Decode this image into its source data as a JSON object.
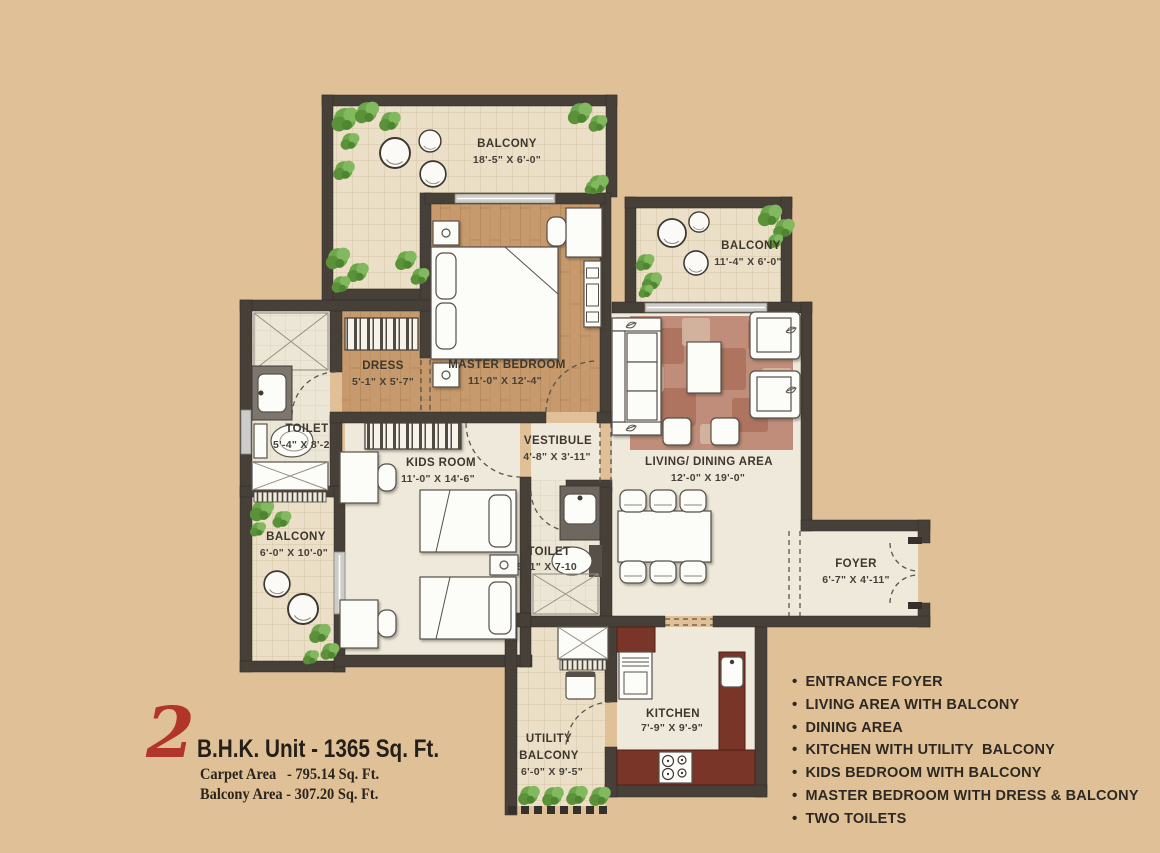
{
  "meta": {
    "description": "2 BHK apartment floor plan"
  },
  "colors": {
    "background": "#e0c197",
    "wall": "#474039",
    "accent_red": "#b23529",
    "wood_floor": "#c79a6d",
    "balcony_tile": "#ebdfc7",
    "kitchen_counter": "#7a3529",
    "rug": "#c08d7b"
  },
  "title": {
    "big_number": "2",
    "heading": "B.H.K. Unit - 1365 Sq. Ft.",
    "carpet_line": "Carpet Area   - 795.14 Sq. Ft.",
    "balcony_line": "Balcony Area - 307.20 Sq. Ft."
  },
  "bullets": {
    "marker": "•"
  },
  "features": [
    "ENTRANCE FOYER",
    "LIVING AREA WITH BALCONY",
    "DINING AREA",
    "KITCHEN WITH UTILITY  BALCONY",
    "KIDS BEDROOM WITH BALCONY",
    "MASTER BEDROOM WITH DRESS & BALCONY",
    "TWO TOILETS"
  ],
  "rooms": {
    "balcony_top": {
      "name": "BALCONY",
      "dims": "18'-5\" X 6'-0\""
    },
    "balcony_right": {
      "name": "BALCONY",
      "dims": "11'-4\" X 6'-0\""
    },
    "balcony_left": {
      "name": "BALCONY",
      "dims": "6'-0\" X 10'-0\""
    },
    "master_bedroom": {
      "name": "MASTER BEDROOM",
      "dims": "11'-0\" X 12'-4\""
    },
    "dress": {
      "name": "DRESS",
      "dims": "5'-1\" X 5'-7\""
    },
    "toilet_1": {
      "name": "TOILET",
      "dims": "5'-4\" X 8'-2\""
    },
    "kids_room": {
      "name": "KIDS ROOM",
      "dims": "11'-0\" X 14'-6\""
    },
    "vestibule": {
      "name": "VESTIBULE",
      "dims": "4'-8\" X 3'-11\""
    },
    "toilet_2": {
      "name": "TOILET",
      "dims": "5'-1\" X 7-10"
    },
    "living_dining": {
      "name": "LIVING/ DINING AREA",
      "dims": "12'-0\" X 19'-0\""
    },
    "foyer": {
      "name": "FOYER",
      "dims": "6'-7\" X 4'-11\""
    },
    "kitchen": {
      "name": "KITCHEN",
      "dims": "7'-9\" X 9'-9\""
    },
    "utility_balcony": {
      "name_line1": "UTILITY",
      "name_line2": "BALCONY",
      "dims": "6'-0\" X 9'-5\""
    }
  }
}
